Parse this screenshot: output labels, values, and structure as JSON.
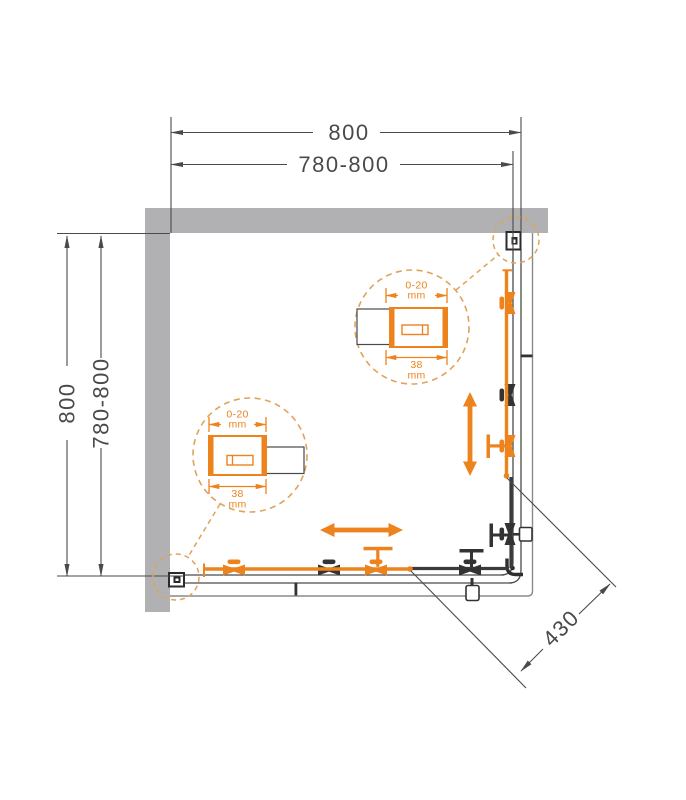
{
  "drawing": {
    "type": "shower-enclosure-plan-view",
    "dims": {
      "top_overall": "800",
      "top_adjust": "780-800",
      "left_overall": "800",
      "left_adjust": "780-800",
      "entry_diagonal": "430"
    },
    "callout_right_wall_profile": {
      "adjust_range": "0-20",
      "adjust_unit": "mm",
      "profile_width": "38",
      "profile_unit": "mm"
    },
    "callout_left_wall_profile": {
      "adjust_range": "0-20",
      "adjust_unit": "mm",
      "profile_width": "38",
      "profile_unit": "mm"
    }
  },
  "colors": {
    "accent_orange": "#ED831C",
    "callout_orange": "#DFA35C",
    "wall_gray": "#B1B1B3",
    "line_dark": "#4A4A4A",
    "hardware_dark": "#333333",
    "boundary_gray": "#8A8A8A"
  }
}
